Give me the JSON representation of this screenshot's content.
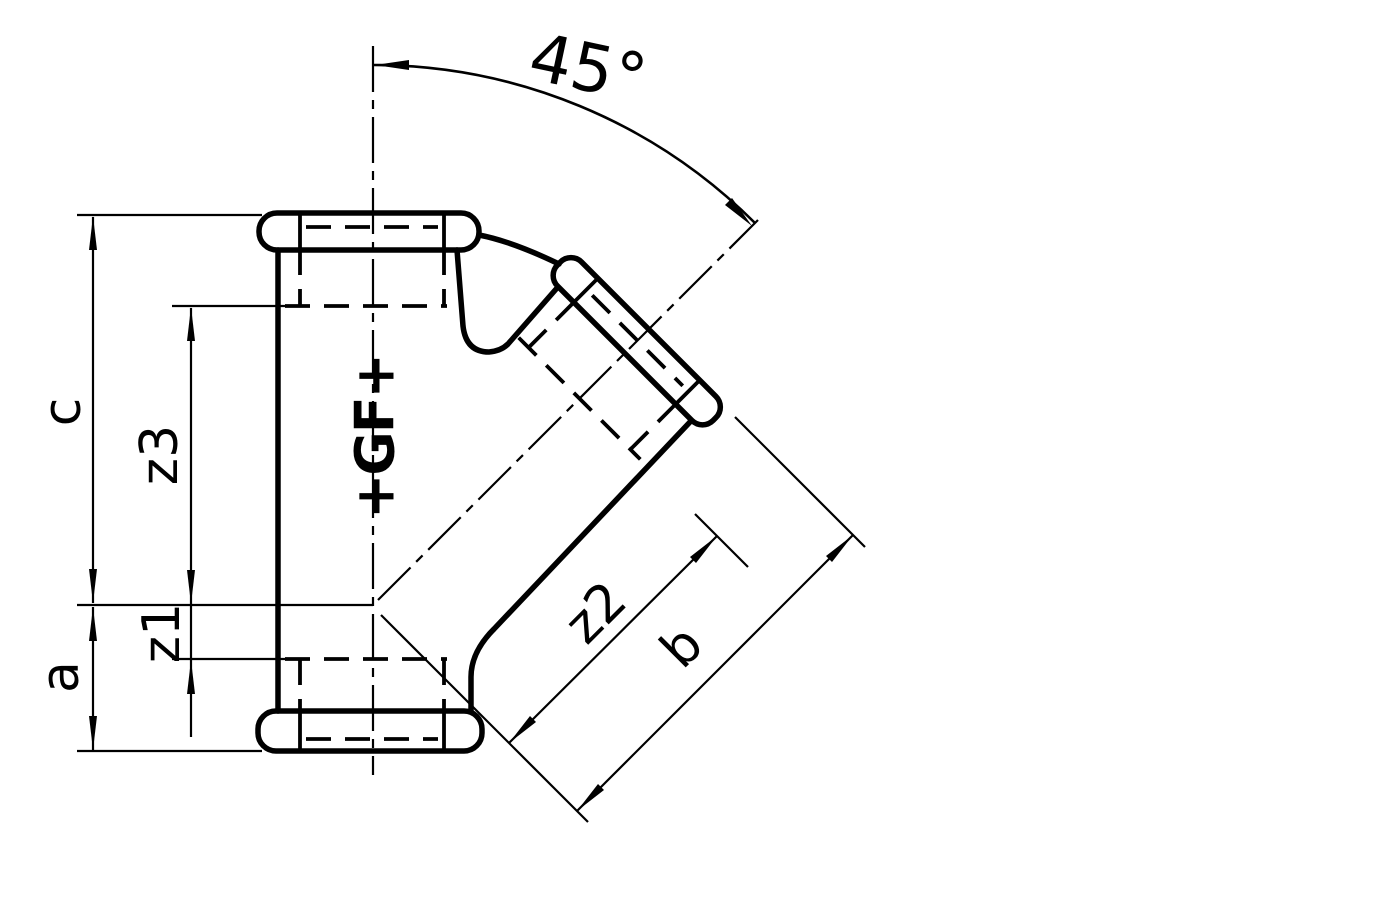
{
  "figure": {
    "background": "#ffffff",
    "line_color": "#000000",
    "logo": "+GF+",
    "labels": {
      "angle": "45°",
      "c": "c",
      "z3": "z3",
      "z1": "z1",
      "a": "a",
      "z2": "z2",
      "b": "b"
    }
  }
}
